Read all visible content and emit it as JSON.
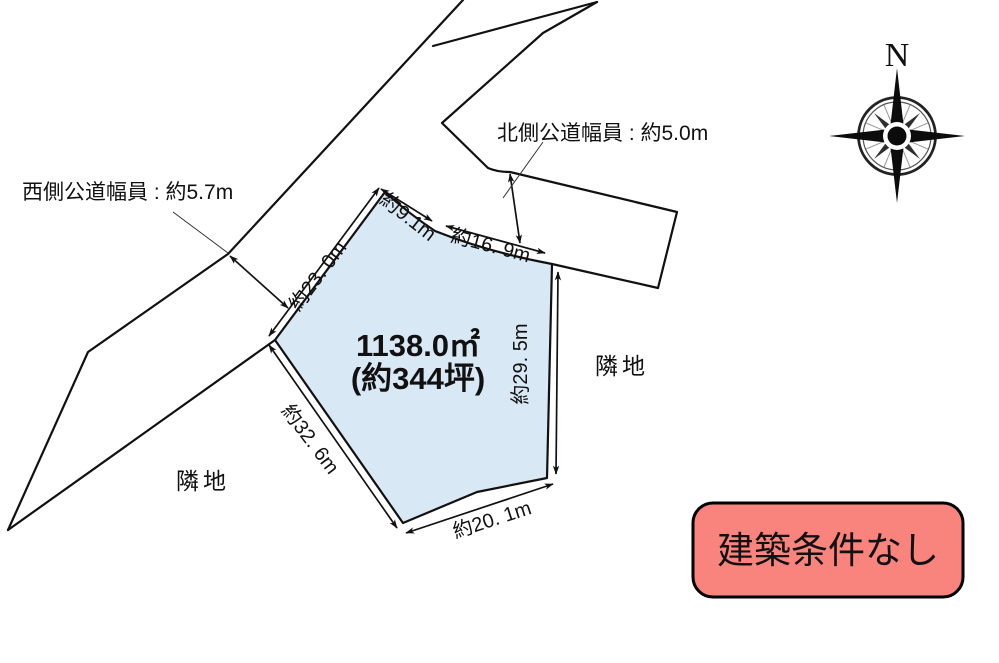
{
  "lot": {
    "area_line1": "1138.0㎡",
    "area_line2": "(約344坪)",
    "fill_color": "#D9E8F5",
    "dimensions": {
      "north_west": "約23. 0m",
      "north": "約9.1m",
      "north_east": "約16. 9m",
      "east": "約29. 5m",
      "south_west": "約32. 6m",
      "south": "約20. 1m"
    }
  },
  "roads": {
    "west_label": "西側公道幅員 : 約5.7m",
    "north_label": "北側公道幅員 : 約5.0m"
  },
  "neighbors": {
    "left": "隣地",
    "right": "隣地"
  },
  "compass": {
    "letter": "N"
  },
  "badge": {
    "label": "建築条件なし",
    "fill_color": "#F9837D",
    "border_color": "#000000"
  }
}
